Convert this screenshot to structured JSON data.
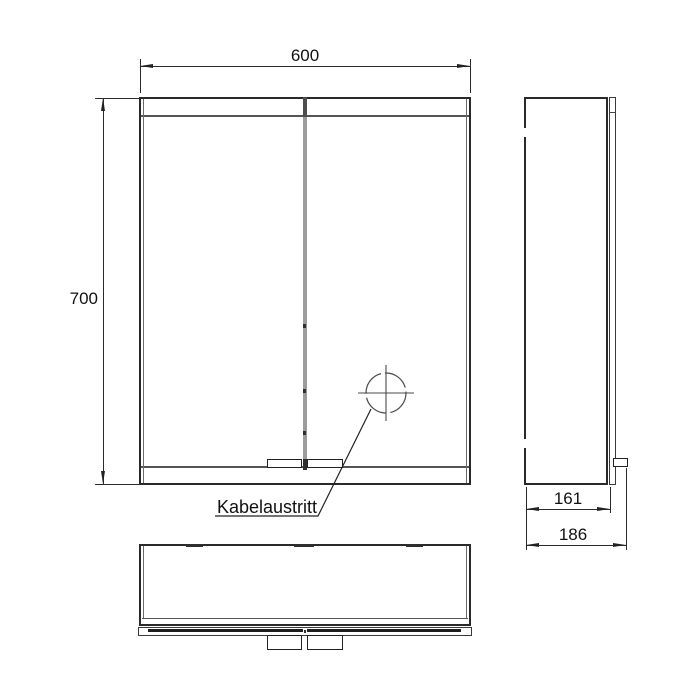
{
  "dimensions": {
    "width": "600",
    "height": "700",
    "depth_body": "161",
    "depth_total": "186"
  },
  "labels": {
    "cable_outlet": "Kabelaustritt"
  },
  "colors": {
    "background": "#ffffff",
    "line": "#2a2a2a",
    "divider_gray": "#9c9c9c"
  }
}
